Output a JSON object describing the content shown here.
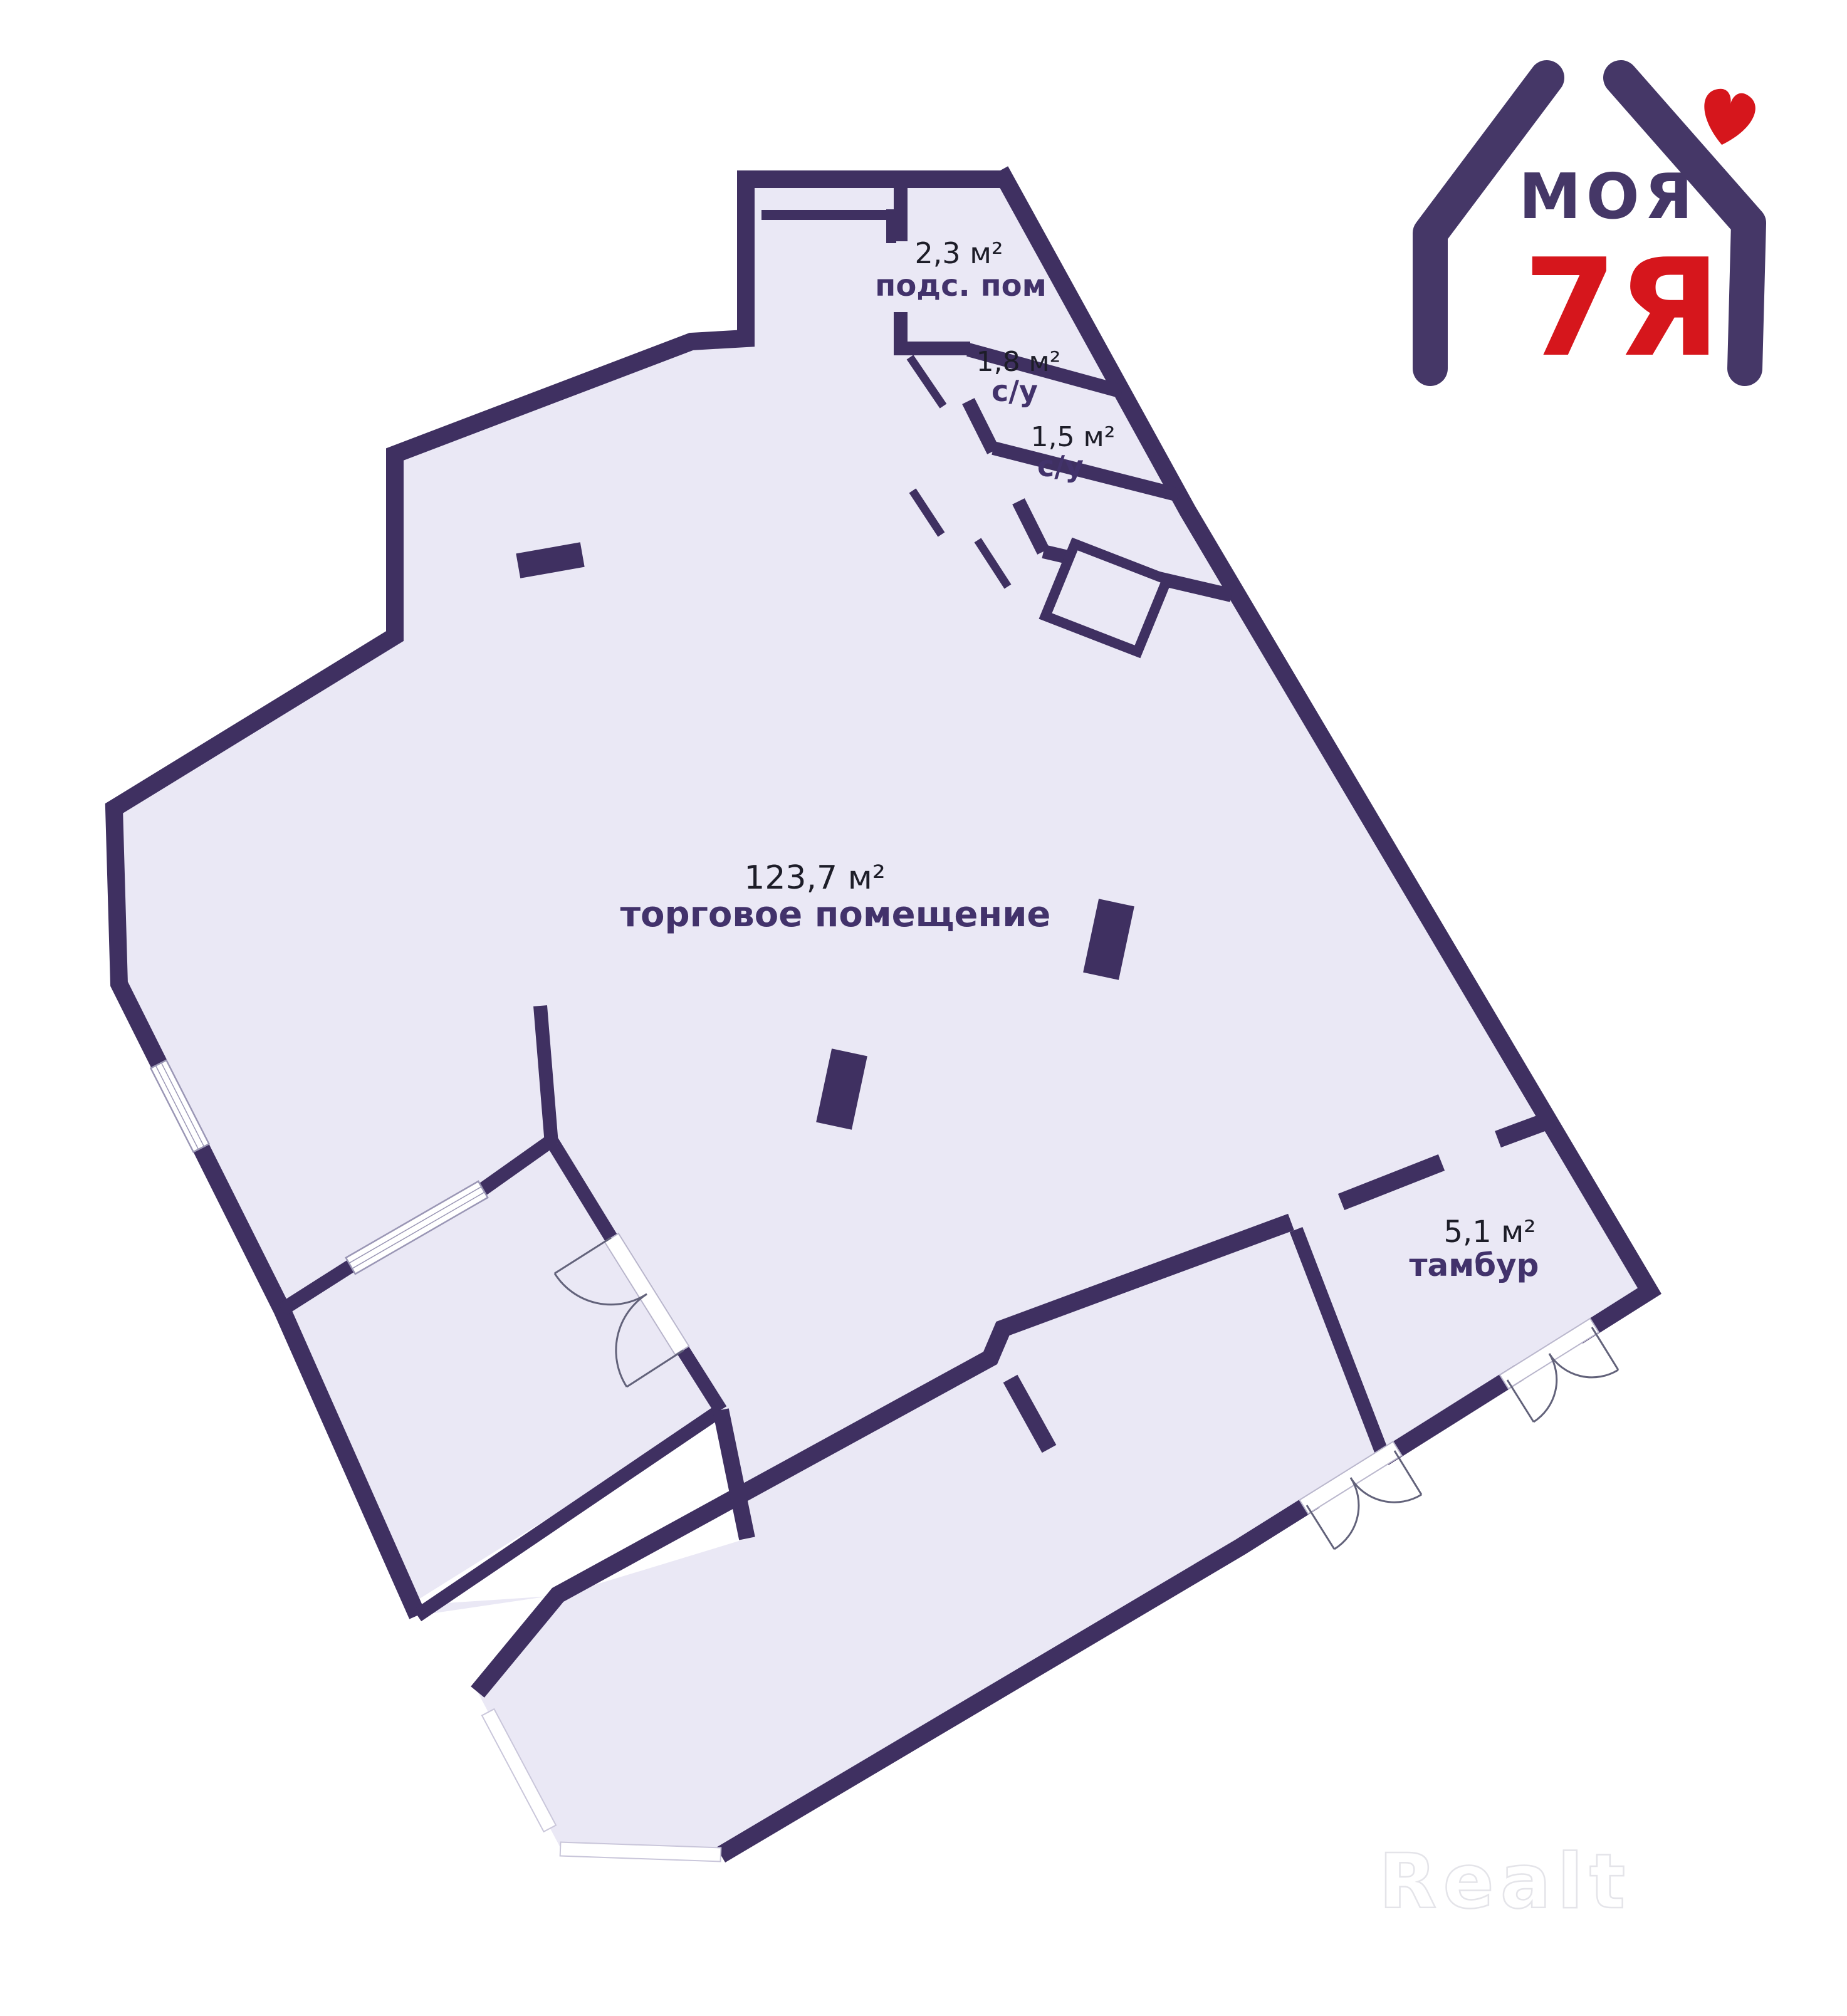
{
  "floorplan": {
    "rooms": [
      {
        "id": "utility-room",
        "area": "2,3 м²",
        "name": "подс. пом"
      },
      {
        "id": "bathroom-1",
        "area": "1,8 м²",
        "name": "с/у"
      },
      {
        "id": "bathroom-2",
        "area": "1,5 м²",
        "name": "с/у"
      },
      {
        "id": "sales-room",
        "area": "123,7 м²",
        "name": "торговое помещение"
      },
      {
        "id": "vestibule",
        "area": "5,1 м²",
        "name": "тамбур"
      }
    ],
    "colors": {
      "wall": "#3f3061",
      "floor": "#eae8f5",
      "area_text": "#1d1d28",
      "name_text": "#42326b",
      "door_arc": "#62627a",
      "window_frame": "#9a96b5"
    }
  },
  "logo": {
    "title": "МОЯ",
    "subtitle": "7Я",
    "icon": "house-heart-icon",
    "colors": {
      "purple": "#453767",
      "red": "#d6161c"
    }
  },
  "watermark": {
    "text": "Realt"
  }
}
